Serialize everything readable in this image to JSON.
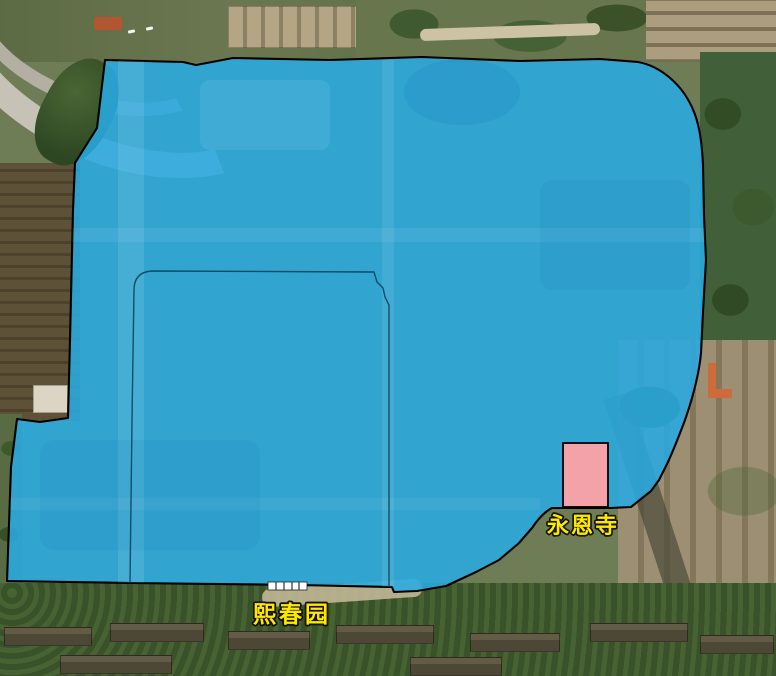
{
  "map": {
    "title": "satellite map with campus boundary overlay",
    "annotations": {
      "campus_area": {
        "fill": "#29AAE1",
        "stroke": "#000000",
        "opacity": "0.88"
      },
      "inner_boundary": {
        "stroke": "#0A3D55"
      },
      "temple_block": {
        "fill": "#F3A2A7",
        "stroke": "#000000"
      }
    },
    "labels": [
      {
        "id": "yongen-temple",
        "text": "永恩寺",
        "color": "#FFE800"
      },
      {
        "id": "xichun-garden",
        "text": "熙春园",
        "color": "#FFE800"
      }
    ]
  }
}
